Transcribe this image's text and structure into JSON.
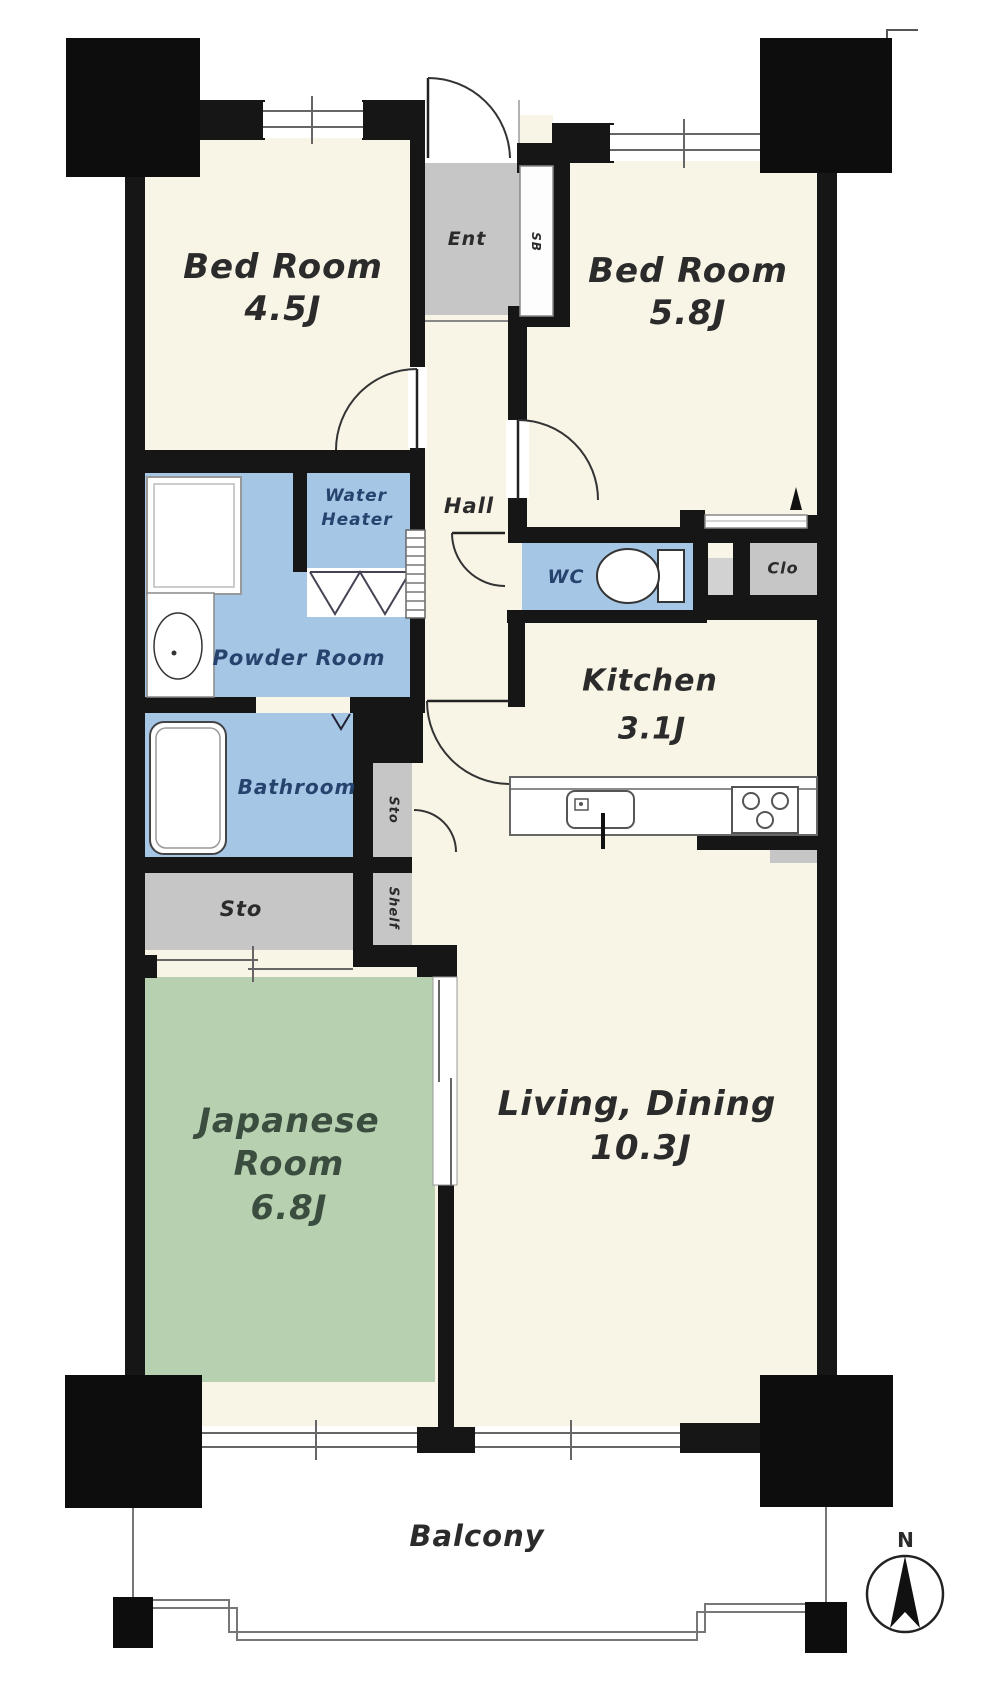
{
  "title": "Apartment floor plan 3LDK",
  "rooms": {
    "bedroom1": {
      "name": "Bed Room",
      "size": "4.5J"
    },
    "bedroom2": {
      "name": "Bed Room",
      "size": "5.8J"
    },
    "kitchen": {
      "name": "Kitchen",
      "size": "3.1J"
    },
    "living": {
      "name": "Living, Dining",
      "size": "10.3J"
    },
    "japanese": {
      "name_line1": "Japanese",
      "name_line2": "Room",
      "size": "6.8J"
    },
    "powder": {
      "name": "Powder Room"
    },
    "bathroom": {
      "name": "Bathroom"
    },
    "wc": {
      "name": "WC"
    },
    "water_heater": {
      "line1": "Water",
      "line2": "Heater"
    },
    "entrance": {
      "name": "Ent"
    },
    "closet": {
      "name": "Clo"
    },
    "hall": {
      "name": "Hall"
    },
    "storage_room": {
      "name": "Sto"
    },
    "storage_strip": {
      "name": "Sto"
    },
    "shelf": {
      "name": "Shelf"
    },
    "shaft": {
      "name": "SB"
    },
    "balcony": {
      "name": "Balcony"
    }
  },
  "compass": {
    "north_label": "N"
  },
  "colors": {
    "wall": "#161616",
    "cream": "#f8f4e6",
    "blue": "#a6c6e6",
    "green": "#b7d1b0",
    "gray": "#c6c6c6",
    "graylight": "#d2d2d2",
    "navy": "#26436e",
    "label": "#2b2b2b",
    "japlabel": "#3b4d3f"
  }
}
